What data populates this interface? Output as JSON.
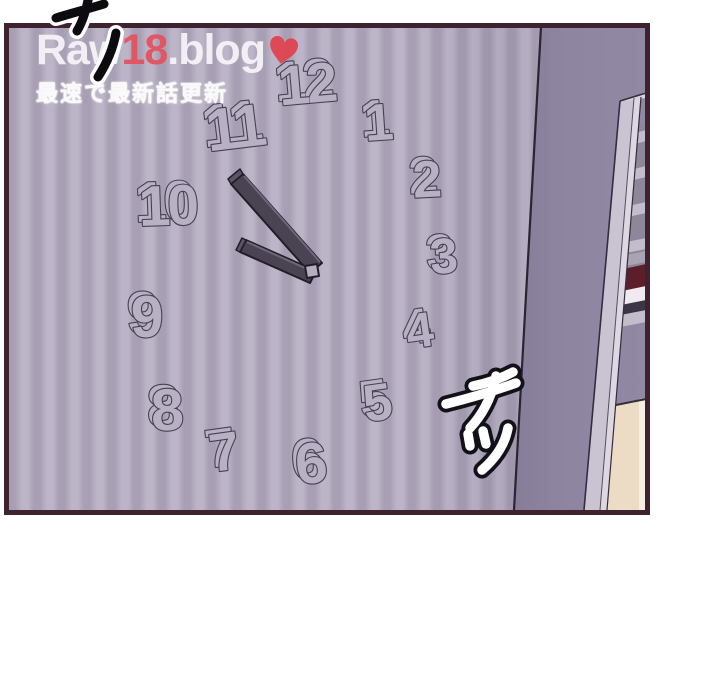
{
  "page": {
    "background_color": "#ffffff"
  },
  "watermark": {
    "brand_prefix": "Raw",
    "brand_number": "18",
    "brand_suffix": ".blog",
    "brand_text_color": "#f7f4f8",
    "brand_number_color": "#e5525e",
    "heart_icon_color": "#e0444f",
    "tagline": "最速で最新話更新",
    "tagline_color": "#ffffff"
  },
  "panel": {
    "border_color": "#3e222d",
    "wall_stripe_light": "#bcb5c7",
    "wall_stripe_dark": "#a89fb4",
    "side_wall_color": "#8e86a0",
    "door_frame_color": "#cac4d2",
    "blind_slat_light": "#c2bccb",
    "blind_slat_dark": "#8e8799",
    "red_band_color": "#5c1f2a",
    "floor_color": "#ecdbc5"
  },
  "clock": {
    "numbers": [
      "12",
      "1",
      "2",
      "3",
      "4",
      "5",
      "6",
      "7",
      "8",
      "9",
      "10",
      "11"
    ],
    "hand_color": "#4a4351",
    "hand_outline_color": "#231d2b",
    "number_fill_color": "#b8b1c3",
    "number_outline_color": "#473f53"
  },
  "sfx": {
    "top_left": {
      "text": "チッ",
      "color_style": "black with white outline"
    },
    "right": {
      "text": "チッ",
      "color_style": "white with black outline"
    }
  }
}
